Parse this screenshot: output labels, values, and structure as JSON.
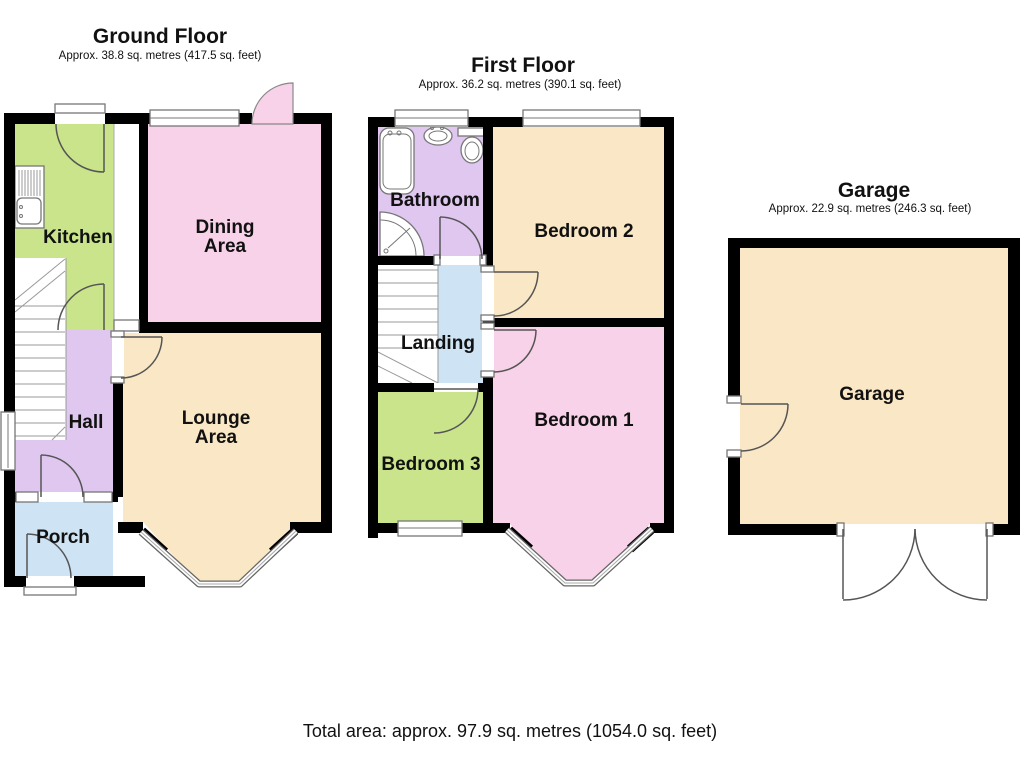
{
  "page": {
    "total_area": "Total area: approx. 97.9 sq. metres (1054.0 sq. feet)"
  },
  "palette": {
    "wall": "#000000",
    "kitchen_green": "#c9e48b",
    "dining_pink": "#f8d2e8",
    "lounge_cream": "#fae7c5",
    "hall_lavender": "#e0c7f0",
    "porch_blue": "#cee4f5"
  },
  "floors": {
    "ground": {
      "title": "Ground Floor",
      "subtitle": "Approx. 38.8 sq. metres (417.5 sq. feet)",
      "rooms": {
        "kitchen": "Kitchen",
        "dining1": "Dining",
        "dining2": "Area",
        "hall": "Hall",
        "lounge1": "Lounge",
        "lounge2": "Area",
        "porch": "Porch"
      }
    },
    "first": {
      "title": "First Floor",
      "subtitle": "Approx. 36.2 sq. metres (390.1 sq. feet)",
      "rooms": {
        "bathroom": "Bathroom",
        "bedroom2": "Bedroom 2",
        "landing": "Landing",
        "bedroom1": "Bedroom 1",
        "bedroom3": "Bedroom 3"
      }
    },
    "garage": {
      "title": "Garage",
      "subtitle": "Approx. 22.9 sq. metres (246.3 sq. feet)",
      "rooms": {
        "garage": "Garage"
      }
    }
  }
}
